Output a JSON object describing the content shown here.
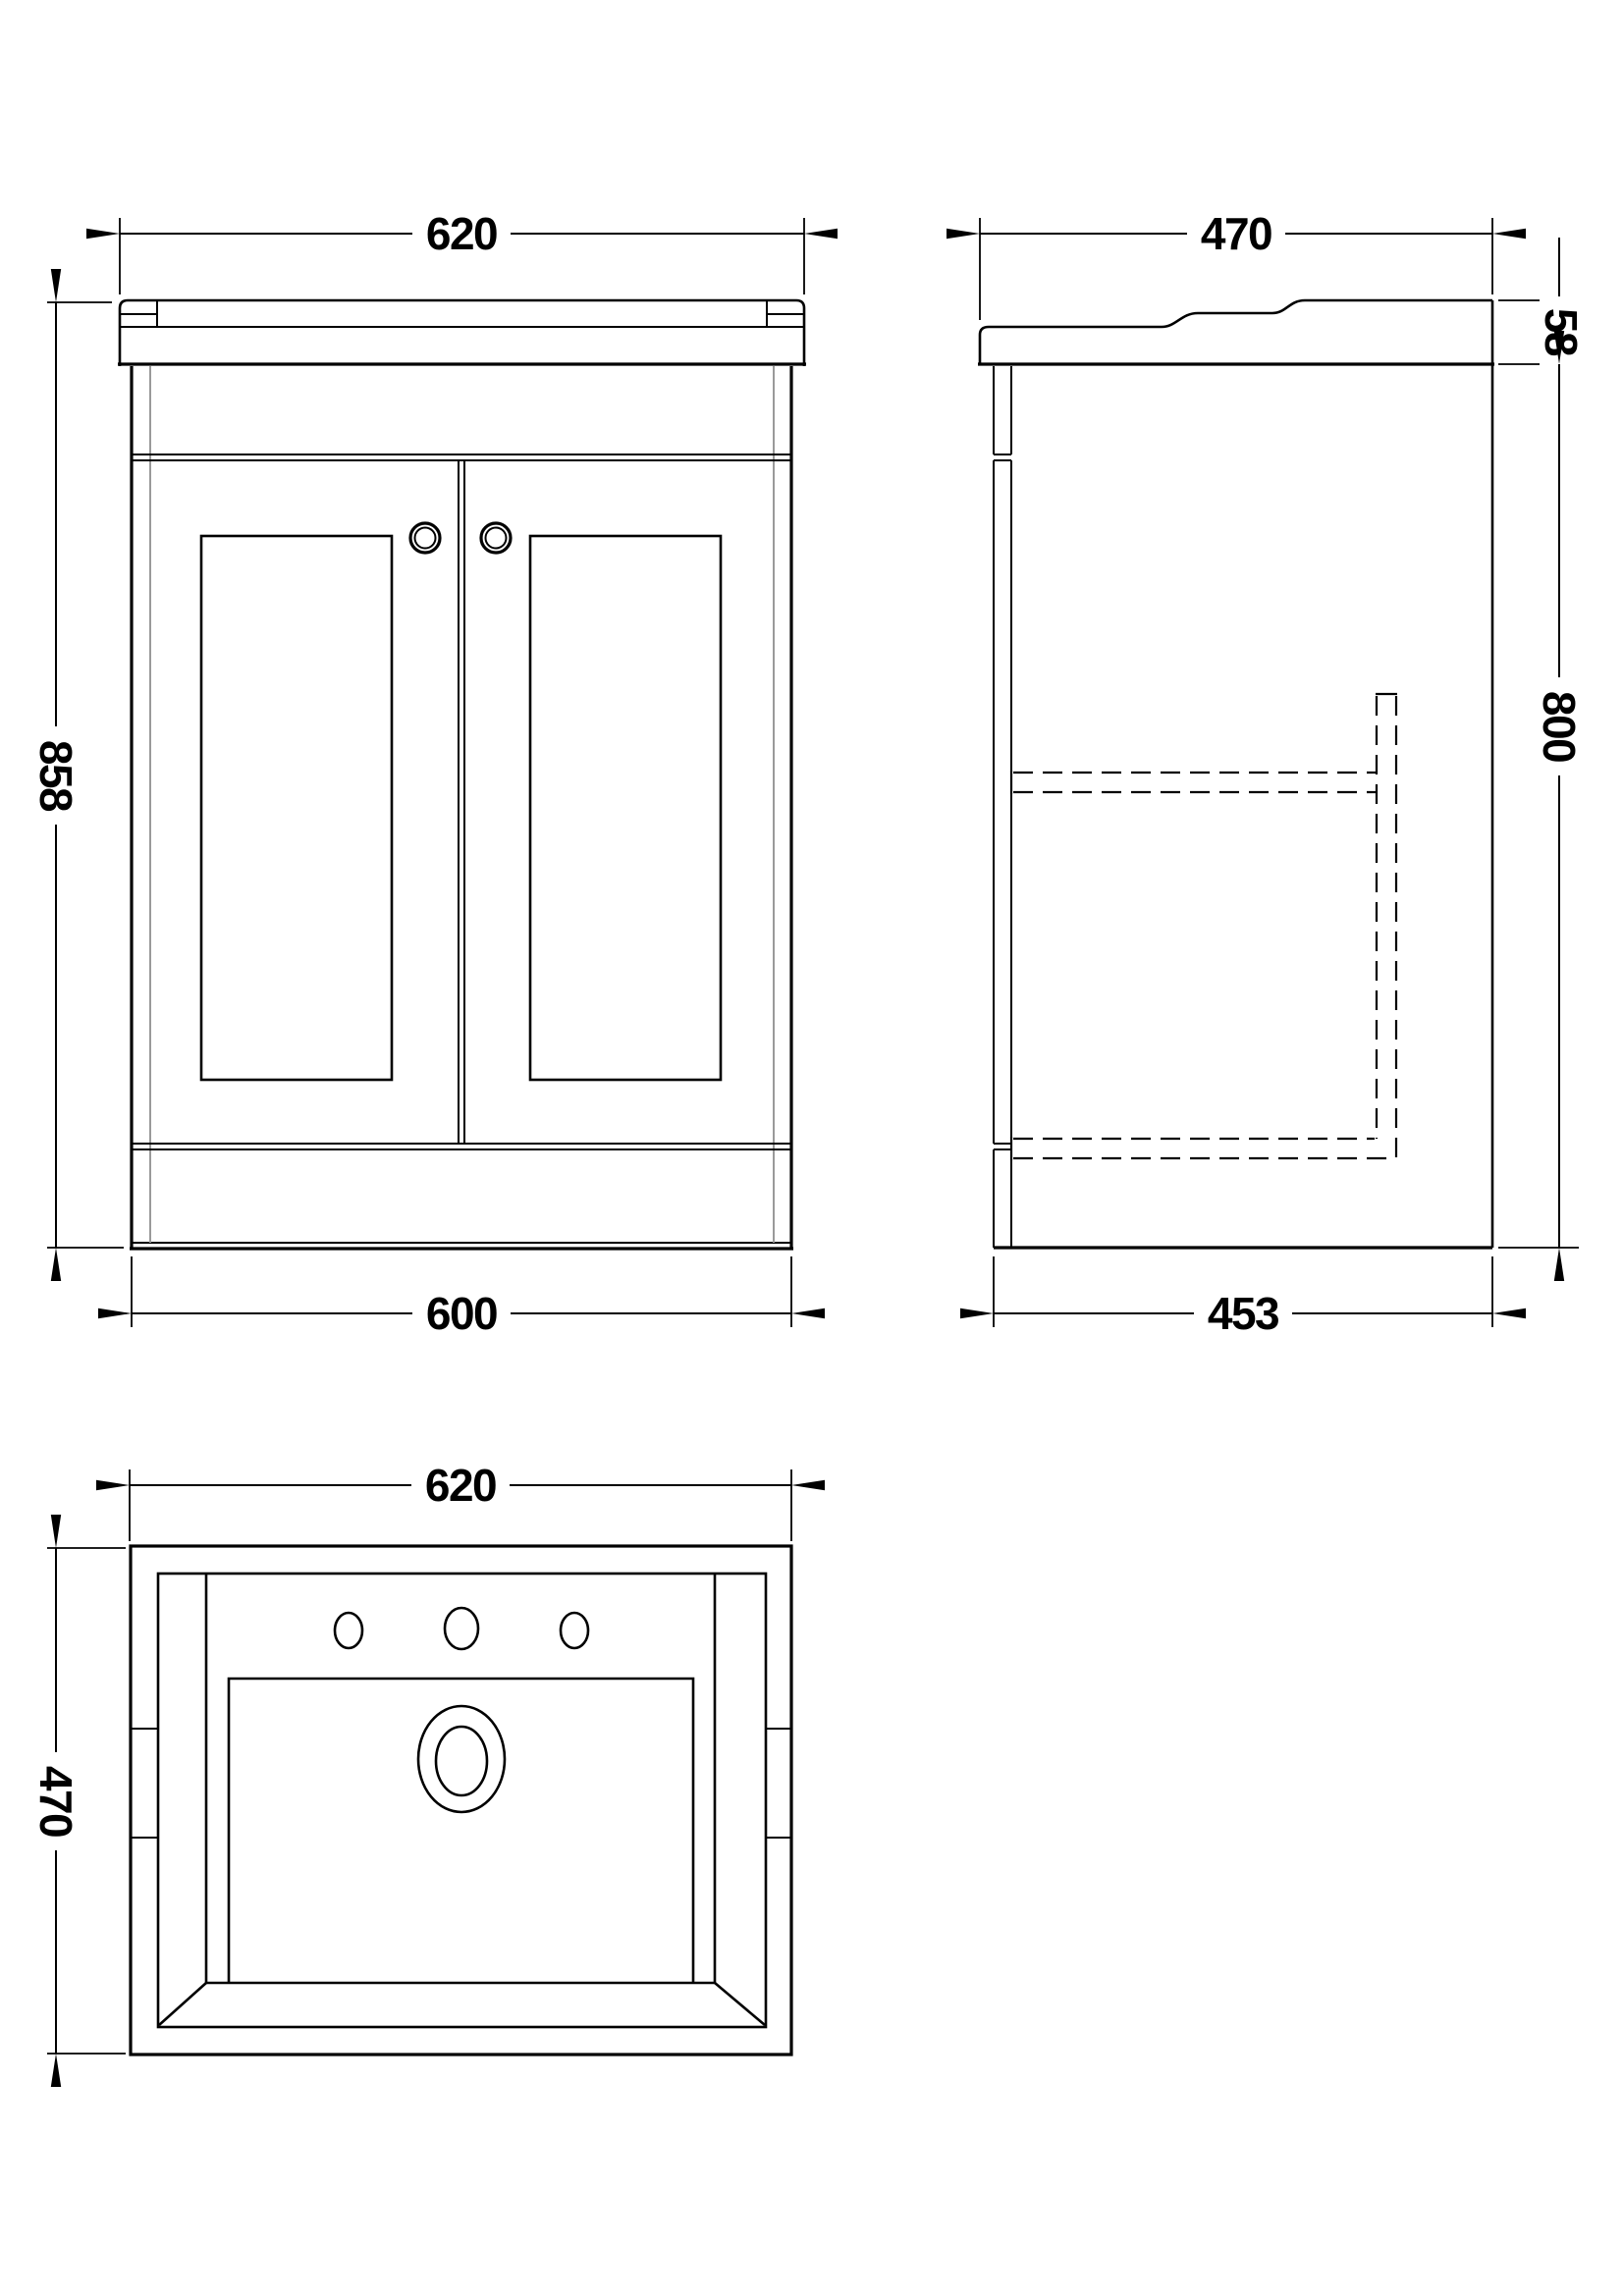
{
  "drawing": {
    "front_view": {
      "top_width": "620",
      "height": "858",
      "bottom_width": "600"
    },
    "side_view": {
      "top_depth": "470",
      "basin_height": "58",
      "body_height": "800",
      "bottom_depth": "453"
    },
    "top_view": {
      "width": "620",
      "depth": "470"
    },
    "colors": {
      "line": "#000000",
      "panel_gray": "#9a9a9a",
      "background": "#ffffff"
    }
  }
}
